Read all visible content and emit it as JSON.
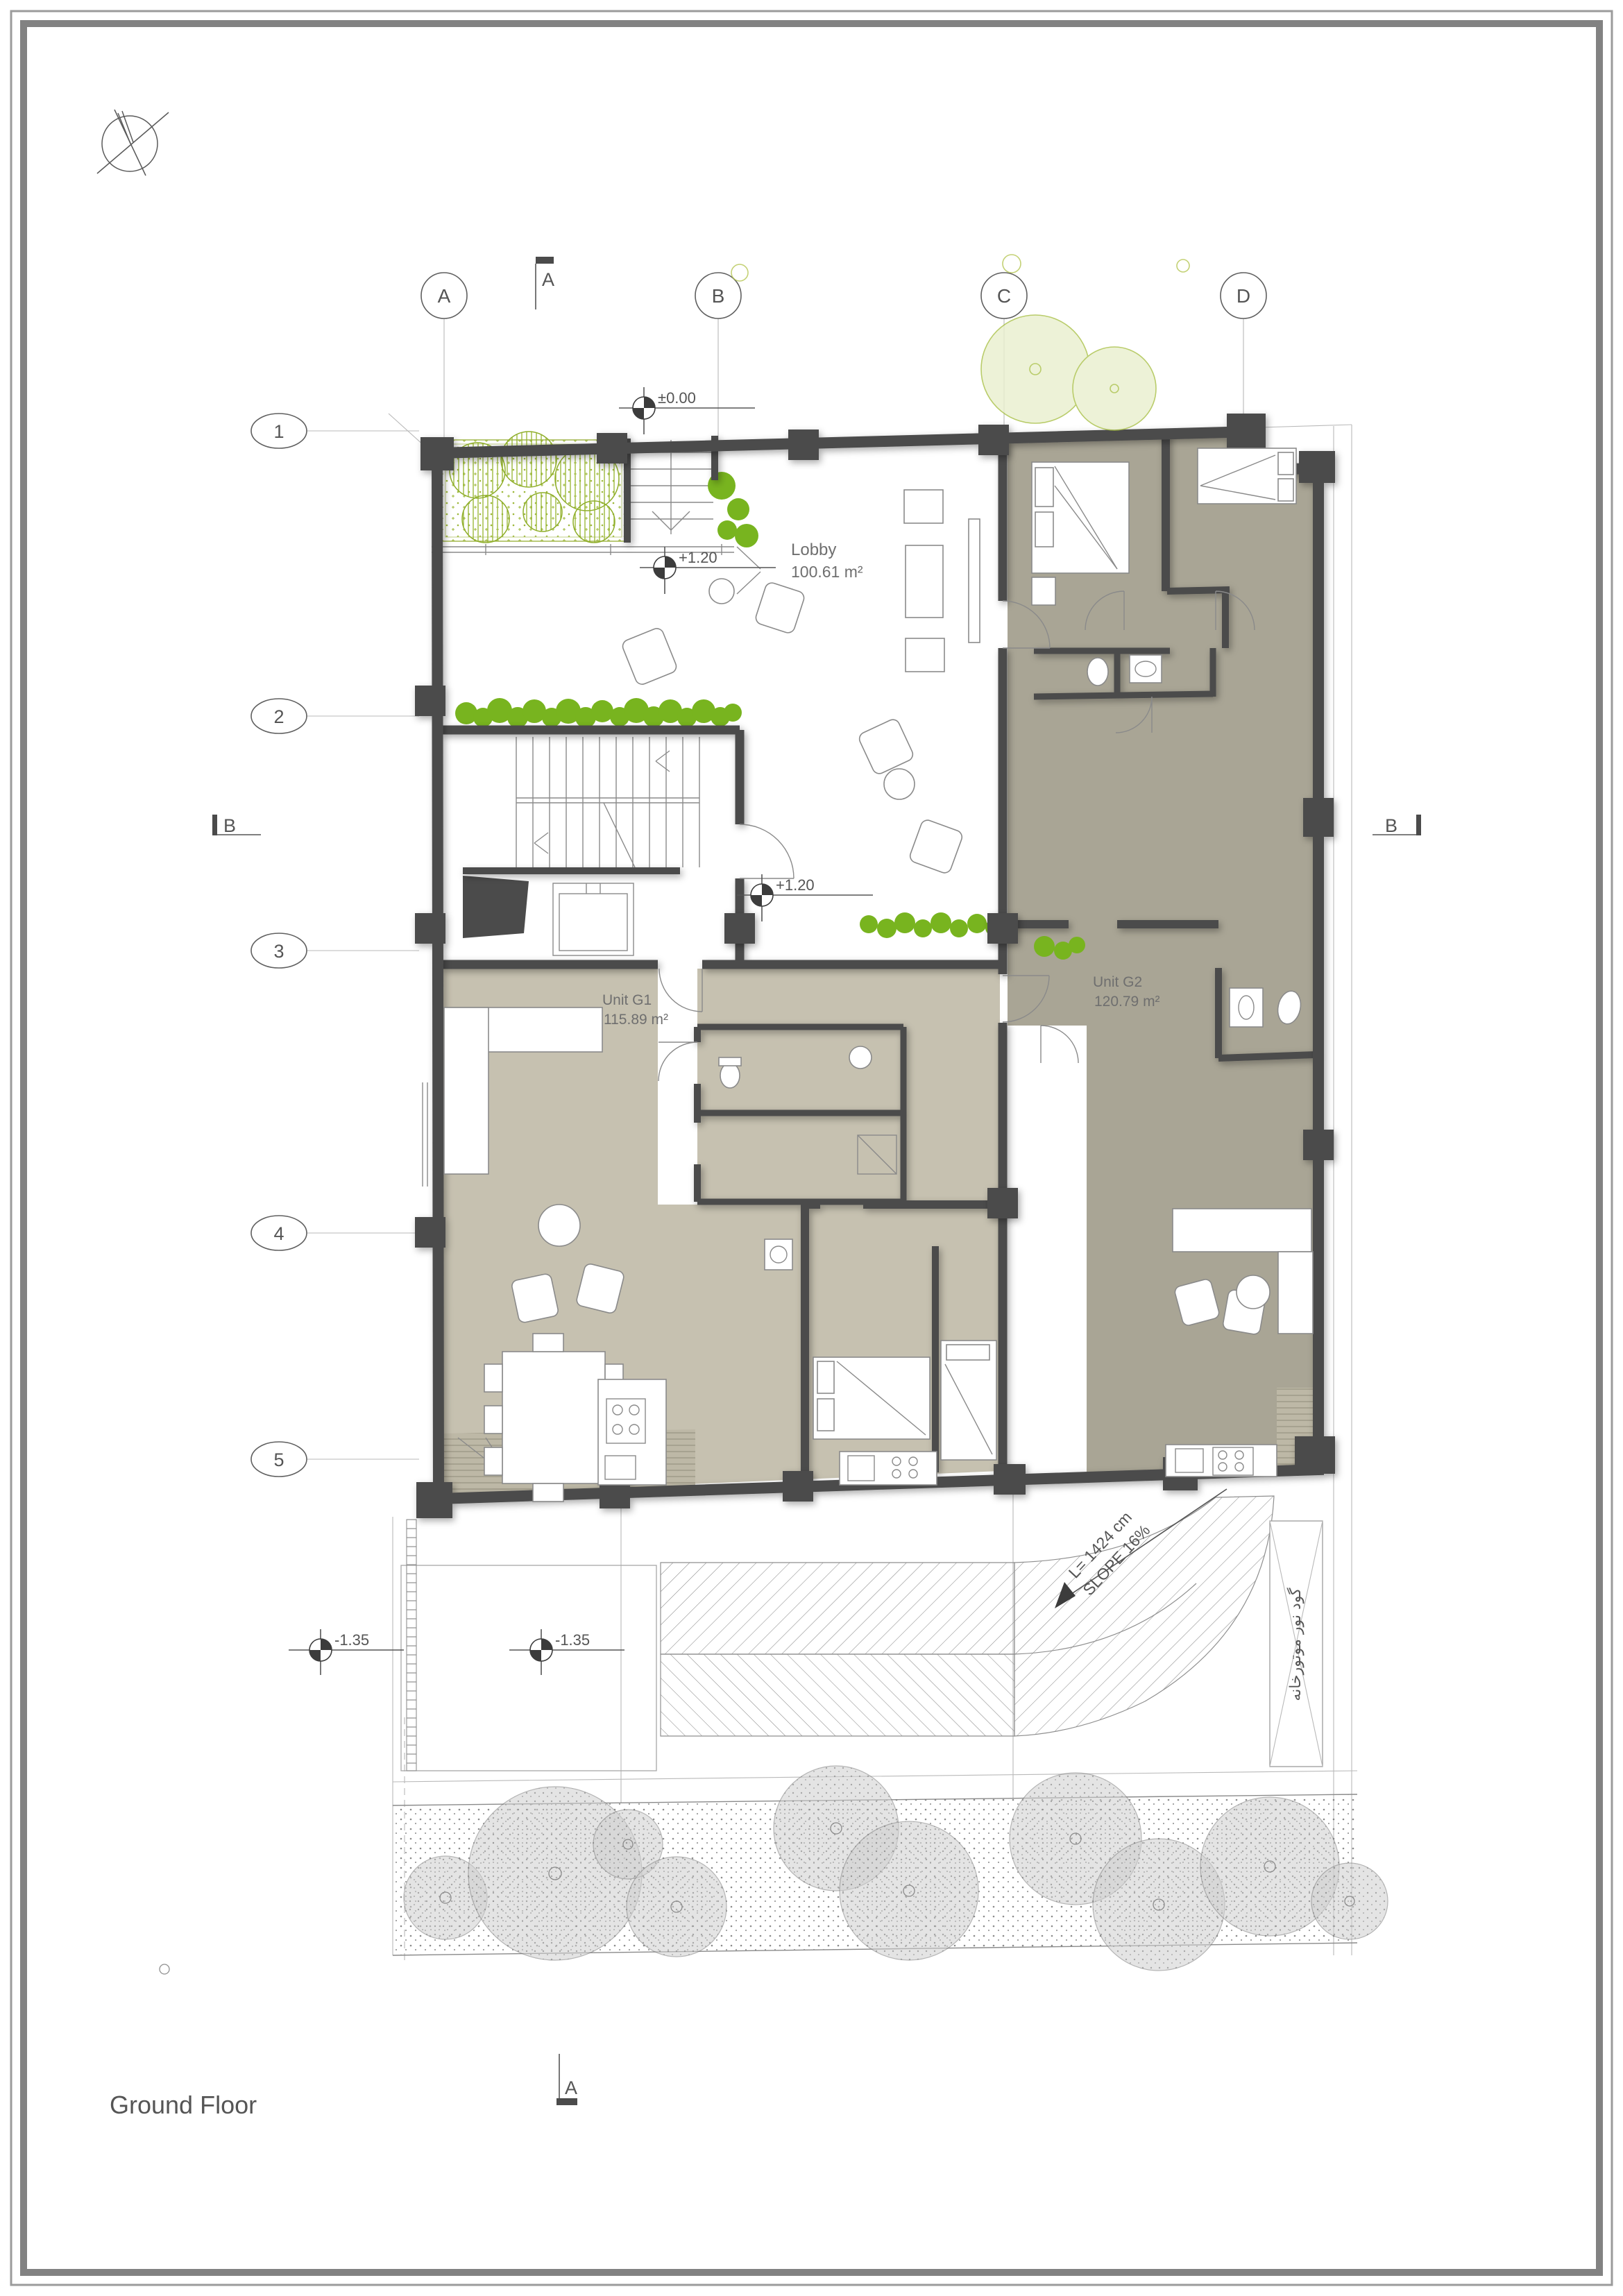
{
  "title": "Ground Floor",
  "grid": {
    "columns": [
      "A",
      "B",
      "C",
      "D"
    ],
    "rows": [
      "1",
      "2",
      "3",
      "4",
      "5"
    ]
  },
  "sections": {
    "top": "A",
    "bottom": "A",
    "left": "B",
    "right": "B"
  },
  "levels": {
    "entry": "±0.00",
    "lobby_upper": "+1.20",
    "lobby_lower": "+1.20",
    "yard_left": "-1.35",
    "yard_right": "-1.35"
  },
  "rooms": {
    "lobby": {
      "name": "Lobby",
      "area": "100.61 m²"
    },
    "unit_g1": {
      "name": "Unit G1",
      "area": "115.89 m²"
    },
    "unit_g2": {
      "name": "Unit G2",
      "area": "120.79 m²"
    }
  },
  "ramp": {
    "length_label": "L= 1424 cm",
    "slope_label": "SLOPE 16%"
  },
  "annotations": {
    "light_well": "گود نور موتورخانه"
  },
  "colors": {
    "wall": "#4b4b4b",
    "unit_g1": "#c6c1b0",
    "unit_g2": "#a9a595",
    "deck": "#bdb8a6",
    "hedge": "#78b41f",
    "tree_line": "#8fae2a",
    "light_tree": "#e9efce",
    "light_tree_stroke": "#a8c045",
    "gray_tree": "#cfcfcf",
    "line": "#8a8a8a",
    "text": "#6f6f6f",
    "frame": "#848484",
    "marker": "#3c3c3c"
  }
}
